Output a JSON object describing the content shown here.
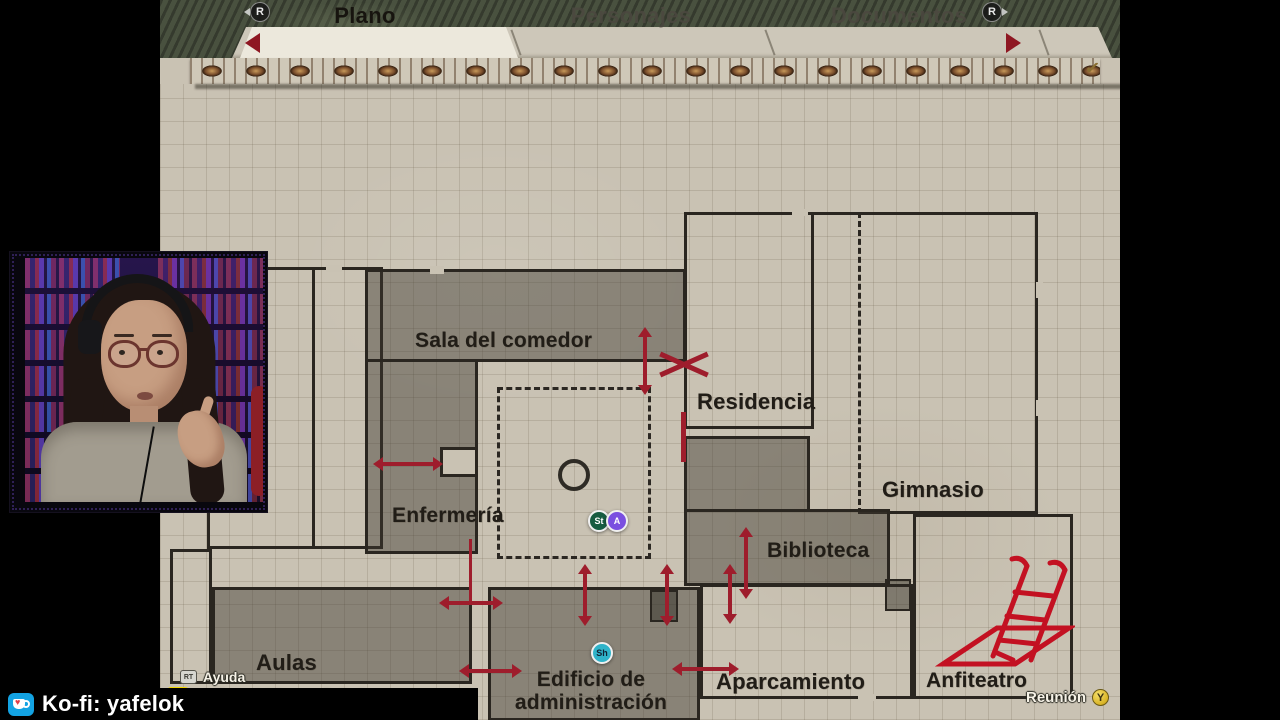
{
  "shoulder_buttons": {
    "left": "R",
    "right": "R"
  },
  "tabs": {
    "prev_arrow": "left",
    "next_arrow": "right",
    "active": "Plano",
    "items": [
      {
        "label": "Plano"
      },
      {
        "label": "Personajes"
      },
      {
        "label": "Documentos"
      }
    ]
  },
  "map": {
    "rooms": [
      {
        "id": "sala-del-comedor",
        "label": "Sala del comedor",
        "visited": true
      },
      {
        "id": "enfermeria",
        "label": "Enfermería",
        "visited": true
      },
      {
        "id": "residencia",
        "label": "Residencia",
        "visited": false
      },
      {
        "id": "gimnasio",
        "label": "Gimnasio",
        "visited": false
      },
      {
        "id": "biblioteca",
        "label": "Biblioteca",
        "visited": true
      },
      {
        "id": "aulas",
        "label": "Aulas",
        "visited": true
      },
      {
        "id": "edificio-administracion",
        "label": "Edificio de administración",
        "visited": true
      },
      {
        "id": "aparcamiento",
        "label": "Aparcamiento",
        "visited": false
      },
      {
        "id": "anfiteatro",
        "label": "Anfiteatro",
        "visited": false
      }
    ],
    "player_badges": [
      {
        "label": "St",
        "color": "#175c41"
      },
      {
        "label": "A",
        "color": "#7a4fe0"
      },
      {
        "label": "Sh",
        "color": "#2fb3c9"
      }
    ],
    "colors": {
      "paper": "#c9c2b3",
      "walls": "#2a2620",
      "room_fill": "#8d897c",
      "door_marker_red": "#9e1d2c"
    }
  },
  "hints": {
    "ayuda_button": "RT",
    "ayuda": "Ayuda",
    "salir": "Salir",
    "reunion": "Reunión",
    "reunion_button": "Y"
  },
  "stream": {
    "kofi": "Ko-fi: yafelok",
    "alias": "Alias MP: yafelok"
  }
}
